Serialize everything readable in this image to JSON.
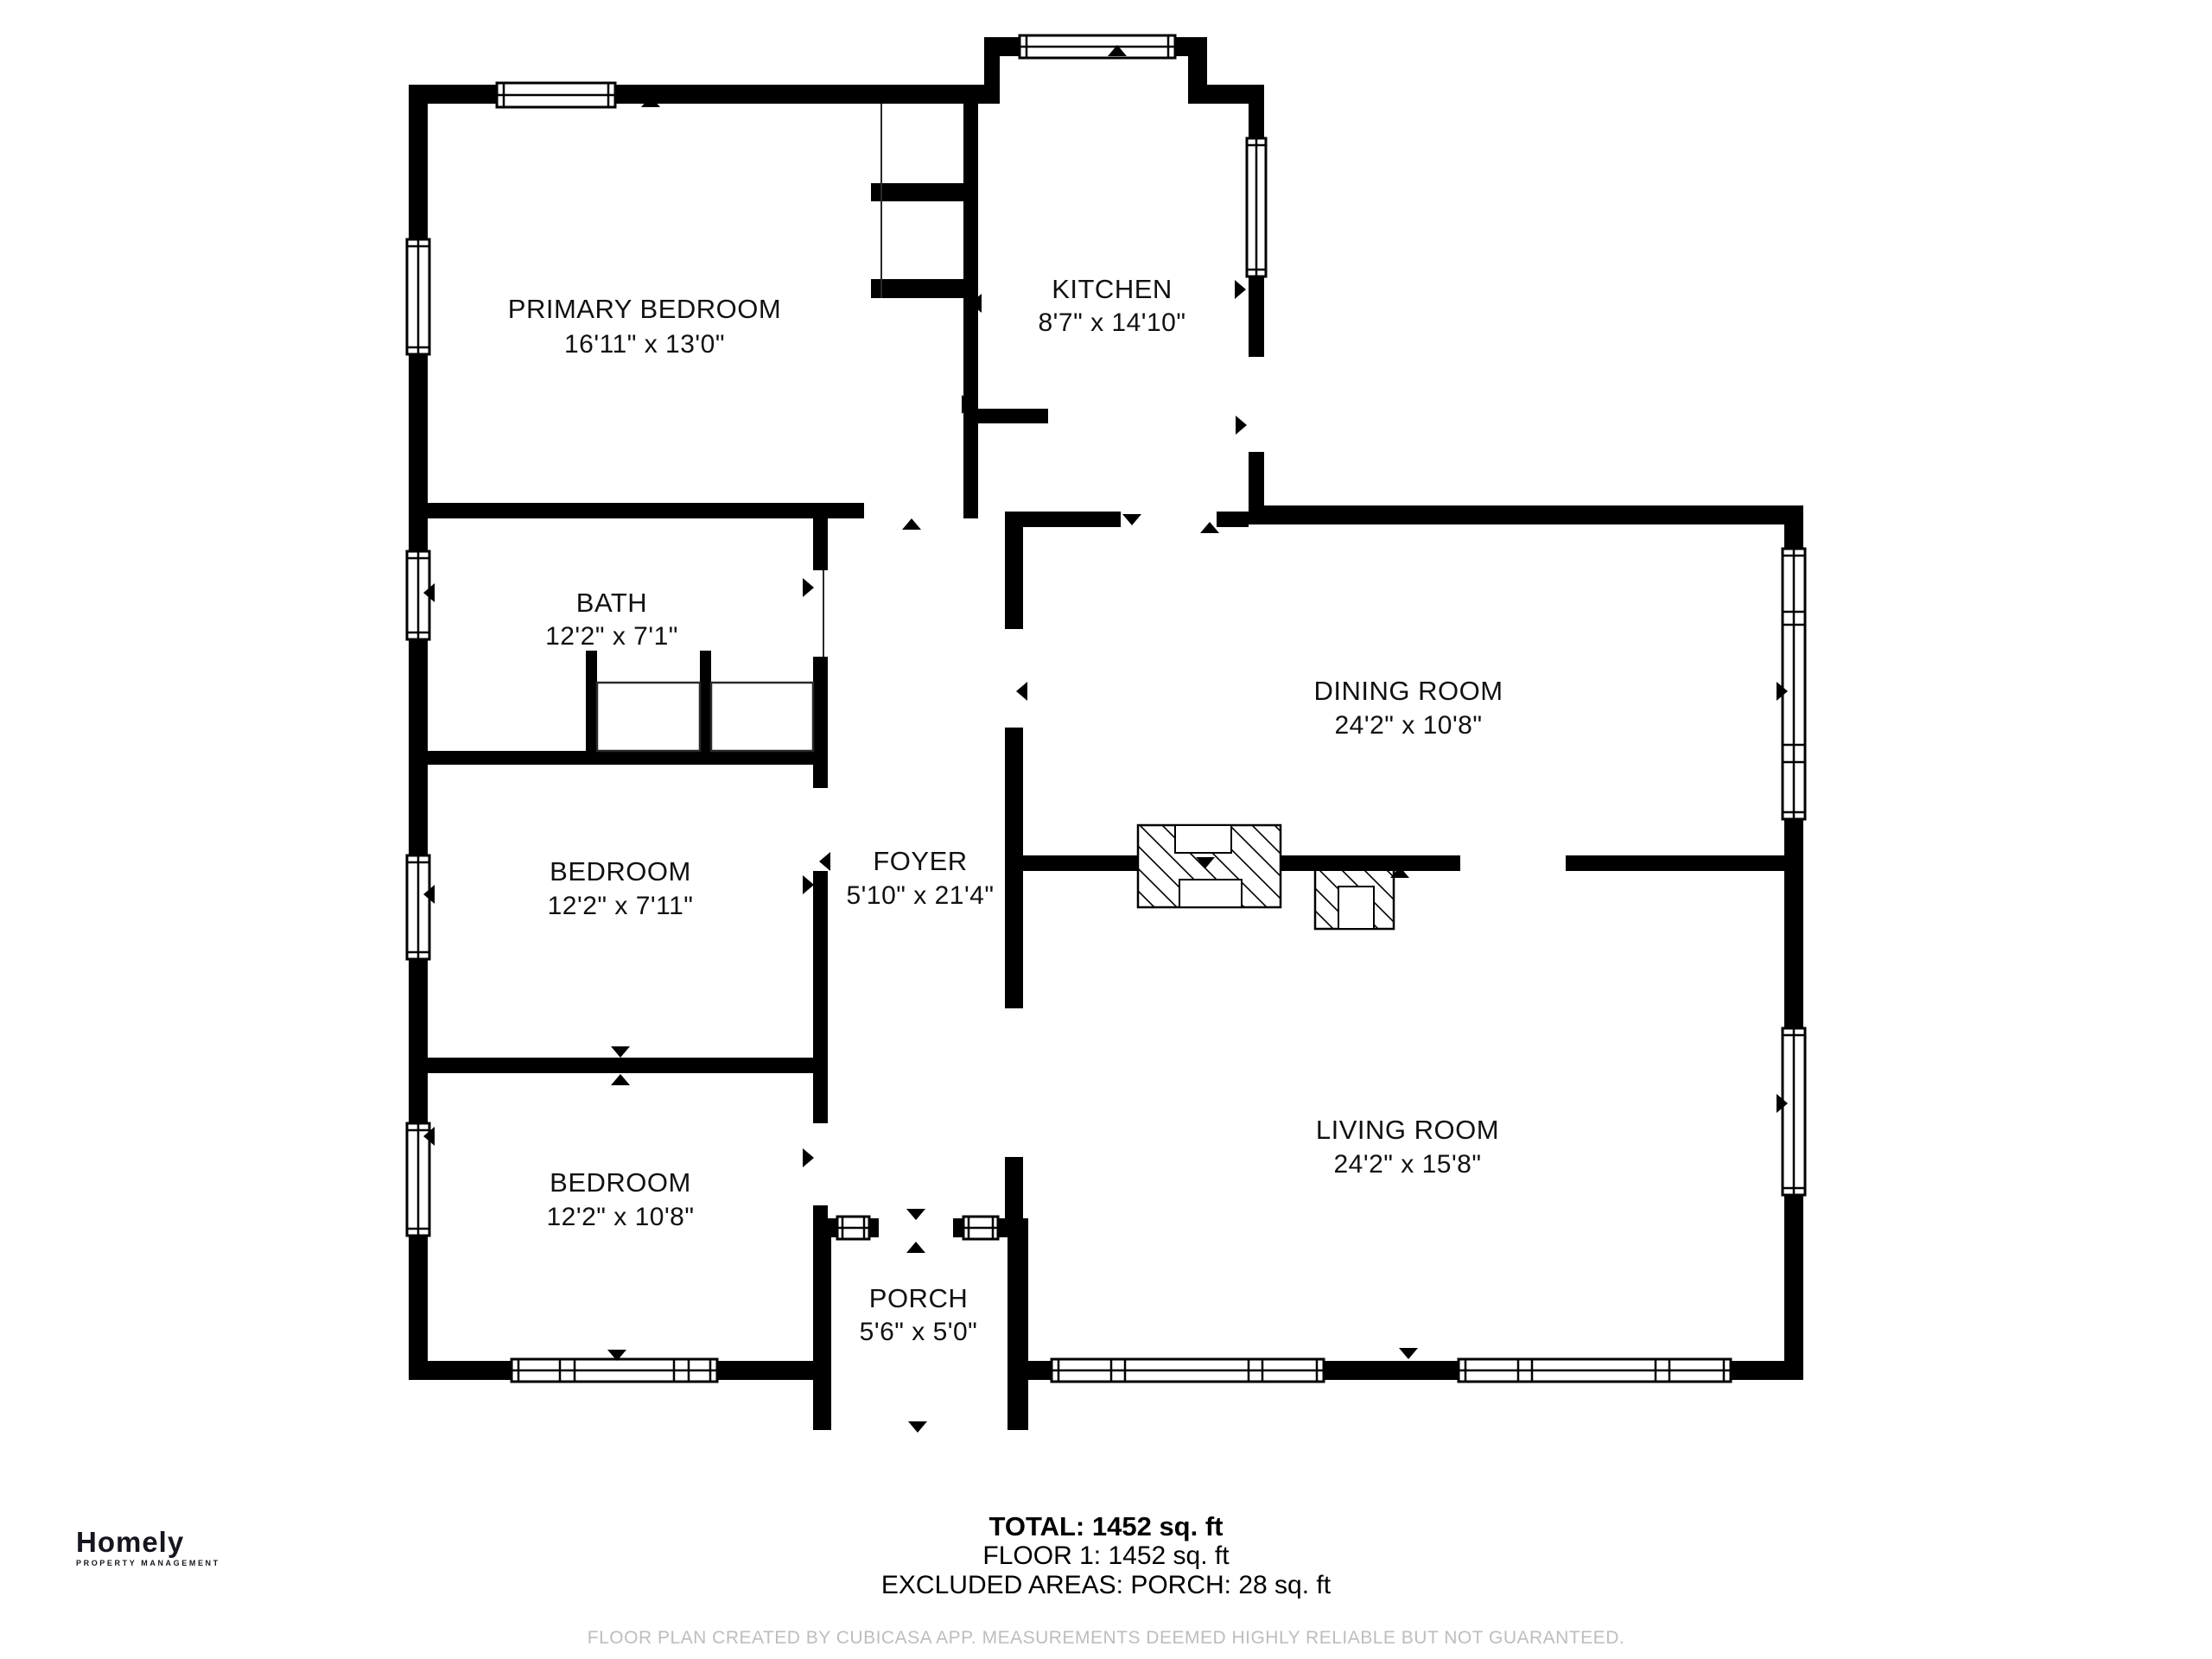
{
  "branding": {
    "logo_text": "Homely",
    "logo_subtext": "PROPERTY MANAGEMENT"
  },
  "rooms": [
    {
      "id": "primary-bedroom",
      "name": "PRIMARY BEDROOM",
      "dimensions": "16'11\" x 13'0\""
    },
    {
      "id": "kitchen",
      "name": "KITCHEN",
      "dimensions": "8'7\" x 14'10\""
    },
    {
      "id": "bath",
      "name": "BATH",
      "dimensions": "12'2\" x 7'1\""
    },
    {
      "id": "bedroom-middle",
      "name": "BEDROOM",
      "dimensions": "12'2\" x 7'11\""
    },
    {
      "id": "foyer",
      "name": "FOYER",
      "dimensions": "5'10\" x 21'4\""
    },
    {
      "id": "dining-room",
      "name": "DINING ROOM",
      "dimensions": "24'2\" x 10'8\""
    },
    {
      "id": "bedroom-lower",
      "name": "BEDROOM",
      "dimensions": "12'2\" x 10'8\""
    },
    {
      "id": "living-room",
      "name": "LIVING ROOM",
      "dimensions": "24'2\" x 15'8\""
    },
    {
      "id": "porch",
      "name": "PORCH",
      "dimensions": "5'6\" x 5'0\""
    }
  ],
  "summary": {
    "total": "TOTAL: 1452 sq. ft",
    "floor1": "FLOOR 1: 1452 sq. ft",
    "excluded": "EXCLUDED AREAS: PORCH: 28 sq. ft"
  },
  "disclaimer": "FLOOR PLAN CREATED BY CUBICASA APP. MEASUREMENTS DEEMED HIGHLY RELIABLE BUT NOT GUARANTEED.",
  "colors": {
    "wall": "#000000",
    "label": "#111111",
    "disclaimer_gray": "#bdbdbd",
    "logo": "#16161f"
  }
}
